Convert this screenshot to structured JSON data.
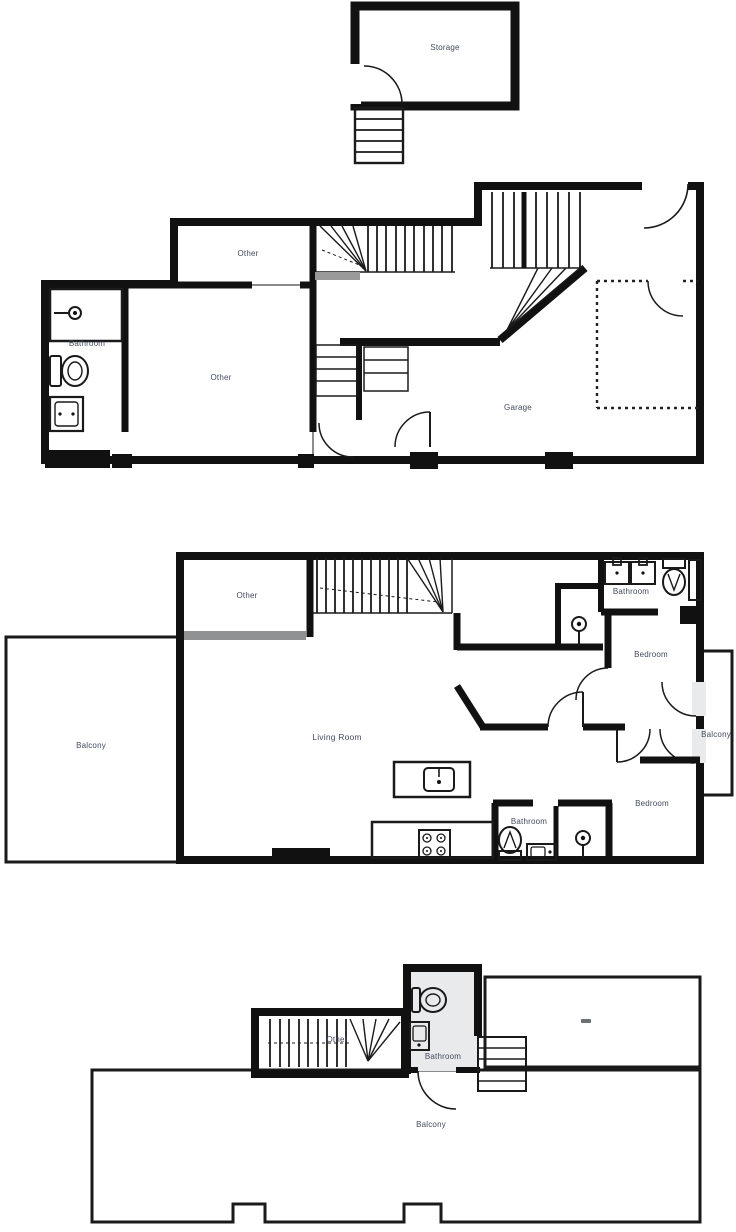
{
  "document": {
    "type": "multi-floor residential floor plan",
    "floor_count": 4
  },
  "colors": {
    "wall": "#111111",
    "floor_fill": "#e9eaec",
    "outdoor_fill": "#ffffff",
    "label": "#414b5e",
    "glass_partition_gray": "#8f9193",
    "landing_gray": "#9a9a9a"
  },
  "floors": {
    "storage": {
      "title": "Storage attic",
      "rooms": {
        "storage": "Storage"
      }
    },
    "ground": {
      "title": "Garage level",
      "rooms": {
        "other_top": "Other",
        "bathroom": "Bathroom",
        "other_main": "Other",
        "garage": "Garage"
      }
    },
    "main": {
      "title": "Main living floor",
      "rooms": {
        "other": "Other",
        "balcony_left": "Balcony",
        "living_room": "Living Room",
        "bathroom_top": "Bathroom",
        "bedroom_top": "Bedroom",
        "balcony_right": "Balcony",
        "bathroom_bottom": "Bathroom",
        "bedroom_bottom": "Bedroom"
      }
    },
    "roof": {
      "title": "Roof terrace level",
      "rooms": {
        "other": "Other",
        "bathroom": "Bathroom",
        "balcony": "Balcony"
      }
    }
  }
}
